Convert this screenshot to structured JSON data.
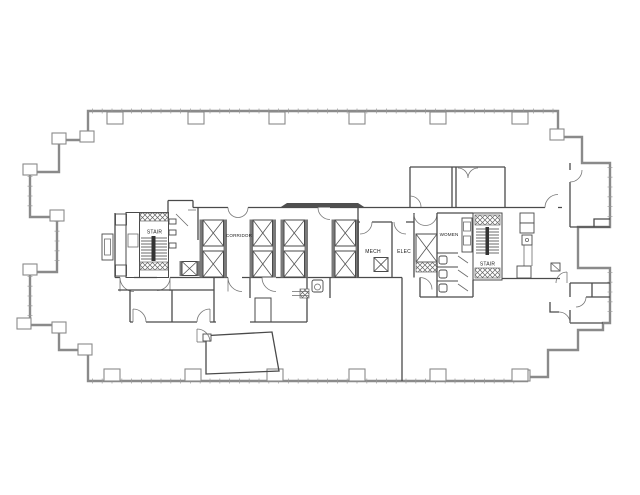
{
  "document": {
    "type": "architectural-floor-plan",
    "description": "Office building floor plan with central service core",
    "background": "#ffffff"
  },
  "palette": {
    "wall_outer": "#8a8a8a",
    "wall_inner": "#4a4a4a",
    "detail": "#6b6b6b",
    "fill_dark": "#4f4f4f",
    "text_color": "#1a1a1a",
    "paper": "#ffffff"
  },
  "labels": {
    "stair_left": "STAIR",
    "corridor": "CORRIDOR",
    "mech": "MECH",
    "elec": "ELEC",
    "women": "WOMEN",
    "stair_right": "STAIR"
  }
}
